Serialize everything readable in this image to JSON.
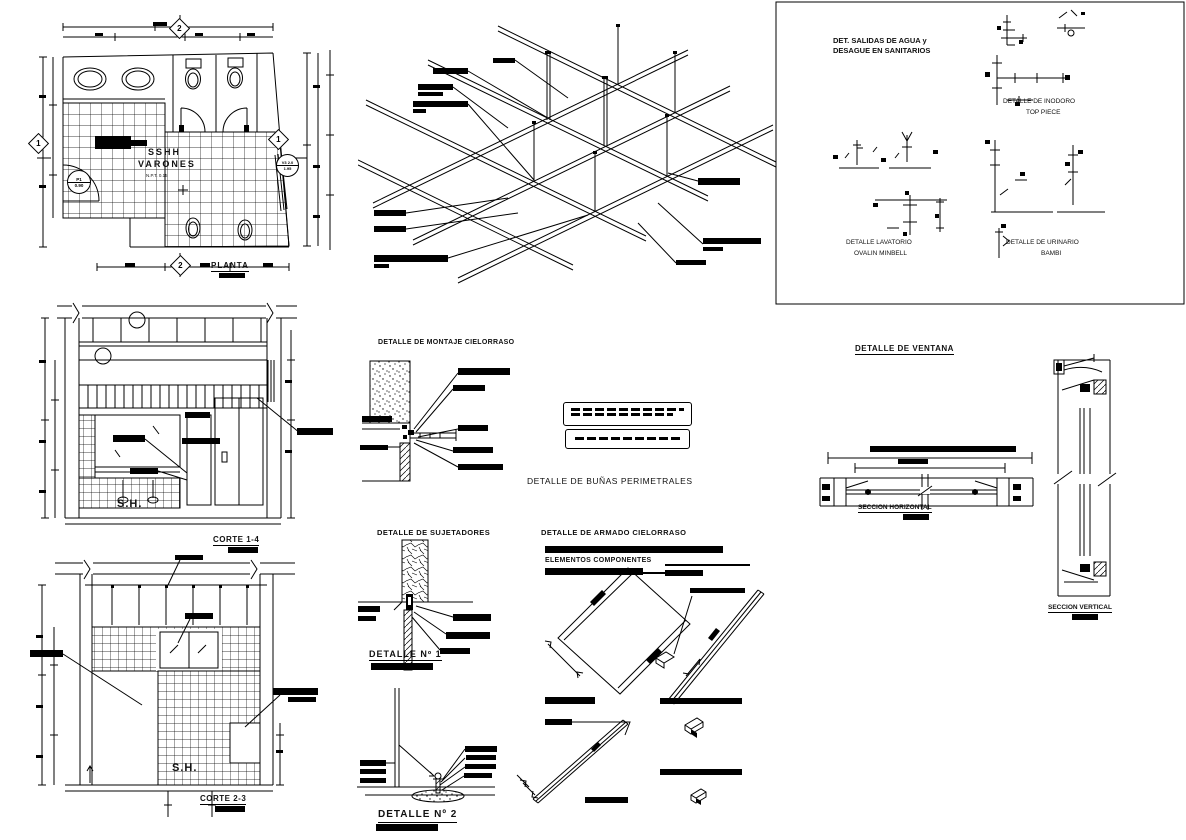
{
  "colors": {
    "ink": "#000000",
    "paper": "#ffffff"
  },
  "plan": {
    "title": "PLANTA",
    "room_name_line1": "SSHH",
    "room_name_line2": "VARONES",
    "floor_level": "N.P.T. 0.15",
    "door_tag": "P1",
    "door_width": "0.90",
    "window_tag_top": "V3 2.0",
    "window_tag_bottom": "1.95",
    "axis_marker_top": "2",
    "axis_marker_bottom": "2",
    "axis_marker_left": "1",
    "axis_marker_right": "1"
  },
  "cortes": {
    "corte_1_4_title": "CORTE 1-4",
    "corte_1_4_room": "S.H.",
    "corte_2_3_title": "CORTE 2-3",
    "corte_2_3_room": "S.H."
  },
  "sanitarios": {
    "panel_title_line1": "DET. SALIDAS DE AGUA y",
    "panel_title_line2": "DESAGUE EN SANITARIOS",
    "inodoro_line1": "DETALLE DE INODORO",
    "inodoro_line2": "TOP PIECE",
    "lavatorio_line1": "DETALLE LAVATORIO",
    "lavatorio_line2": "OVALIN MINBELL",
    "urinario_line1": "DETALLE DE URINARIO",
    "urinario_line2": "BAMBI"
  },
  "cielorraso": {
    "montaje_title": "DETALLE DE MONTAJE CIELORRASO",
    "bunas_title": "DETALLE DE BUÑAS PERIMETRALES",
    "sujetadores_title": "DETALLE DE SUJETADORES",
    "detalle_1_label": "DETALLE  Nº 1",
    "armado_title": "DETALLE DE ARMADO CIELORRASO",
    "elementos_label": "ELEMENTOS COMPONENTES",
    "detalle_2_label": "DETALLE Nº 2"
  },
  "ventana": {
    "title": "DETALLE DE VENTANA",
    "seccion_horizontal": "SECCION HORIZONTAL",
    "seccion_vertical": "SECCION VERTICAL"
  }
}
